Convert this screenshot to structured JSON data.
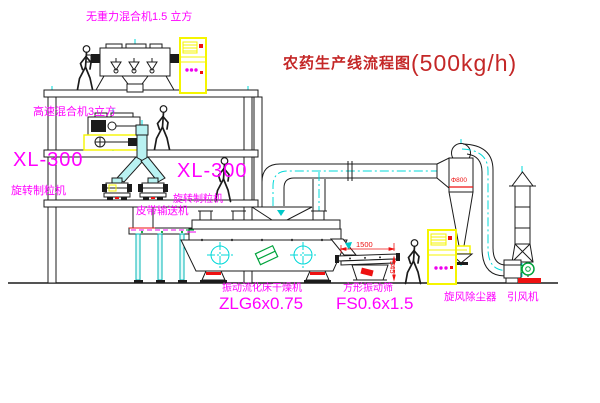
{
  "title": {
    "name": "农药生产线流程图",
    "capacity": "(500kg/h)"
  },
  "labels": {
    "gravity_free_mixer": "无重力混合机1.5 立方",
    "high_speed_mixer": "高速混合机3立方",
    "granulator_left": {
      "model": "XL-300",
      "name": "旋转制粒机"
    },
    "granulator_mid": {
      "model": "XL-300",
      "name": "旋转制粒机"
    },
    "belt_conveyor": "皮带输送机",
    "dryer": {
      "name": "振动流化床干燥机",
      "model": "ZLG6x0.75"
    },
    "screen": {
      "name": "方形振动筛",
      "model": "FS0.6x1.5"
    },
    "cyclone": "旋风除尘器",
    "fan": "引风机"
  },
  "dimensions": {
    "screen_length": "1500",
    "screen_height": "545",
    "cyclone_diameter": "Φ800"
  },
  "colors": {
    "label_magenta": "#ff00ff",
    "title_red": "#c42727",
    "dimension_red": "#ee1111",
    "line_black": "#1b1b1b",
    "centerline_cyan": "#00d8d8",
    "cabinet_yellow": "#f5f500",
    "motor_green": "#00a33c",
    "chute_cyan": "#b9f2f2"
  }
}
